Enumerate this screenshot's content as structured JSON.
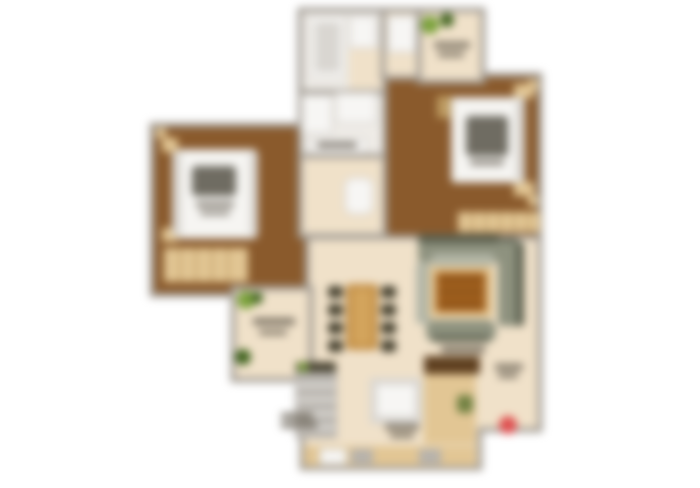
{
  "image": {
    "type": "apartment-floor-plan",
    "style": "blurred top-down colored 2BHK floor plan render",
    "labels_legible": false,
    "background": "#ffffff",
    "blur_px": 4.2
  },
  "palette": {
    "background": "#ffffff",
    "wall": "#a19b93",
    "floor_beige": "#f0e1c9",
    "floor_wood": "#8a5a2c",
    "tile_white": "#efece7",
    "fixture_white": "#f7f6f4",
    "fixture_gray": "#d9d6d1",
    "wood_tan": "#e2c694",
    "wood_tan_dark": "#bd9b61",
    "counter_dark": "#5f4020",
    "appliance_gray": "#b6b2ac",
    "sofa_base": "#8e927f",
    "sofa_dark": "#5d6150",
    "sofa_light": "#b3b6a7",
    "rug_brown": "#a8641f",
    "rug_dark": "#7c4a16",
    "table_wood": "#c28e46",
    "table_wood_light": "#d3a45c",
    "chair_dark": "#46412f",
    "plant_green": "#7ba23c",
    "plant_dark": "#41641f",
    "bed_white": "#f6f5f2",
    "bed_shadow": "#d8d5d0",
    "pillow_smudge": "#575349",
    "smudge": "#60594c",
    "entry_red": "#df5050"
  },
  "rooms": [
    {
      "id": "bathroom",
      "furniture": [
        "shower-cubicle",
        "washbasin",
        "vanity-counter"
      ]
    },
    {
      "id": "toilet",
      "furniture": [
        "wc"
      ]
    },
    {
      "id": "utility",
      "furniture": [
        "white-fixture"
      ]
    },
    {
      "id": "balcony-upper-right",
      "furniture": [
        "potted-plants"
      ]
    },
    {
      "id": "bedroom-right",
      "furniture": [
        "double-bed",
        "nightstands",
        "wardrobe",
        "dresser"
      ]
    },
    {
      "id": "bedroom-left",
      "furniture": [
        "double-bed",
        "nightstands",
        "wardrobe"
      ]
    },
    {
      "id": "balcony-left",
      "furniture": [
        "potted-plants"
      ]
    },
    {
      "id": "living-dining-hall",
      "furniture": [
        "dining-table-with-chairs",
        "sofa-set",
        "rug-coffee-table"
      ]
    },
    {
      "id": "kitchen",
      "furniture": [
        "shelf-unit",
        "sink",
        "counters",
        "appliances",
        "entry-marker"
      ]
    }
  ]
}
